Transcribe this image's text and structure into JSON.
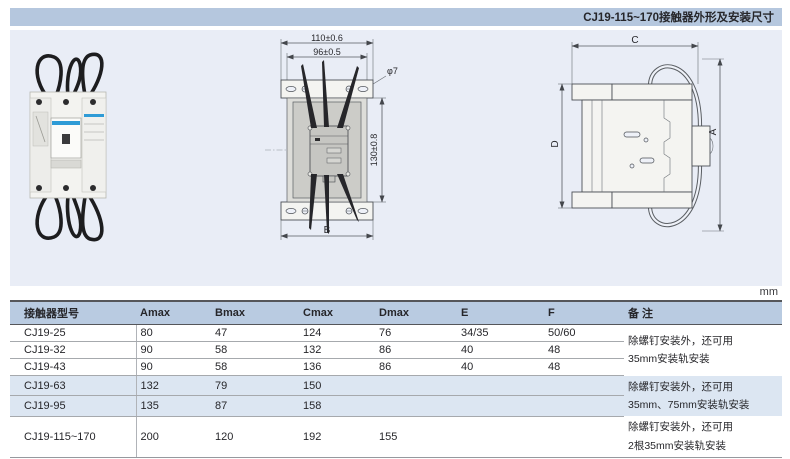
{
  "page": {
    "header_title": "CJ19-115~170接触器外形及安装尺寸",
    "unit_label": "mm"
  },
  "drawings": {
    "front_view": {
      "dim_outer_width": "110±0.6",
      "dim_inner_width": "96±0.5",
      "dim_hole": "φ7",
      "dim_height": "130±0.8",
      "dim_base": "B"
    },
    "side_view": {
      "dim_width": "C",
      "dim_height": "A",
      "dim_body_height": "D"
    }
  },
  "table": {
    "columns": [
      "接触器型号",
      "Amax",
      "Bmax",
      "Cmax",
      "Dmax",
      "E",
      "F",
      "备 注"
    ],
    "rows": [
      [
        "CJ19-25",
        "80",
        "47",
        "124",
        "76",
        "34/35",
        "50/60"
      ],
      [
        "CJ19-32",
        "90",
        "58",
        "132",
        "86",
        "40",
        "48"
      ],
      [
        "CJ19-43",
        "90",
        "58",
        "136",
        "86",
        "40",
        "48"
      ],
      [
        "CJ19-63",
        "132",
        "79",
        "150",
        "",
        "",
        ""
      ],
      [
        "CJ19-95",
        "135",
        "87",
        "158",
        "",
        "",
        ""
      ],
      [
        "CJ19-115~170",
        "200",
        "120",
        "192",
        "155",
        "",
        ""
      ]
    ],
    "remarks": [
      {
        "line1": "除螺钉安装外，还可用",
        "line2": "35mm安装轨安装"
      },
      {
        "line1": "除螺钉安装外，还可用",
        "line2": "35mm、75mm安装轨安装"
      },
      {
        "line1": "除螺钉安装外，还可用",
        "line2": "2根35mm安装轨安装"
      }
    ]
  },
  "colors": {
    "header_bar_bg": "#b5c7de",
    "panel_bg": "#e9edf6",
    "table_header_bg": "#b9cbe1",
    "row_stripe_bg": "#dce6f2",
    "line_dark": "#55565a",
    "line_light": "#a6a9ad",
    "brand_blue": "#2e9bd6"
  }
}
